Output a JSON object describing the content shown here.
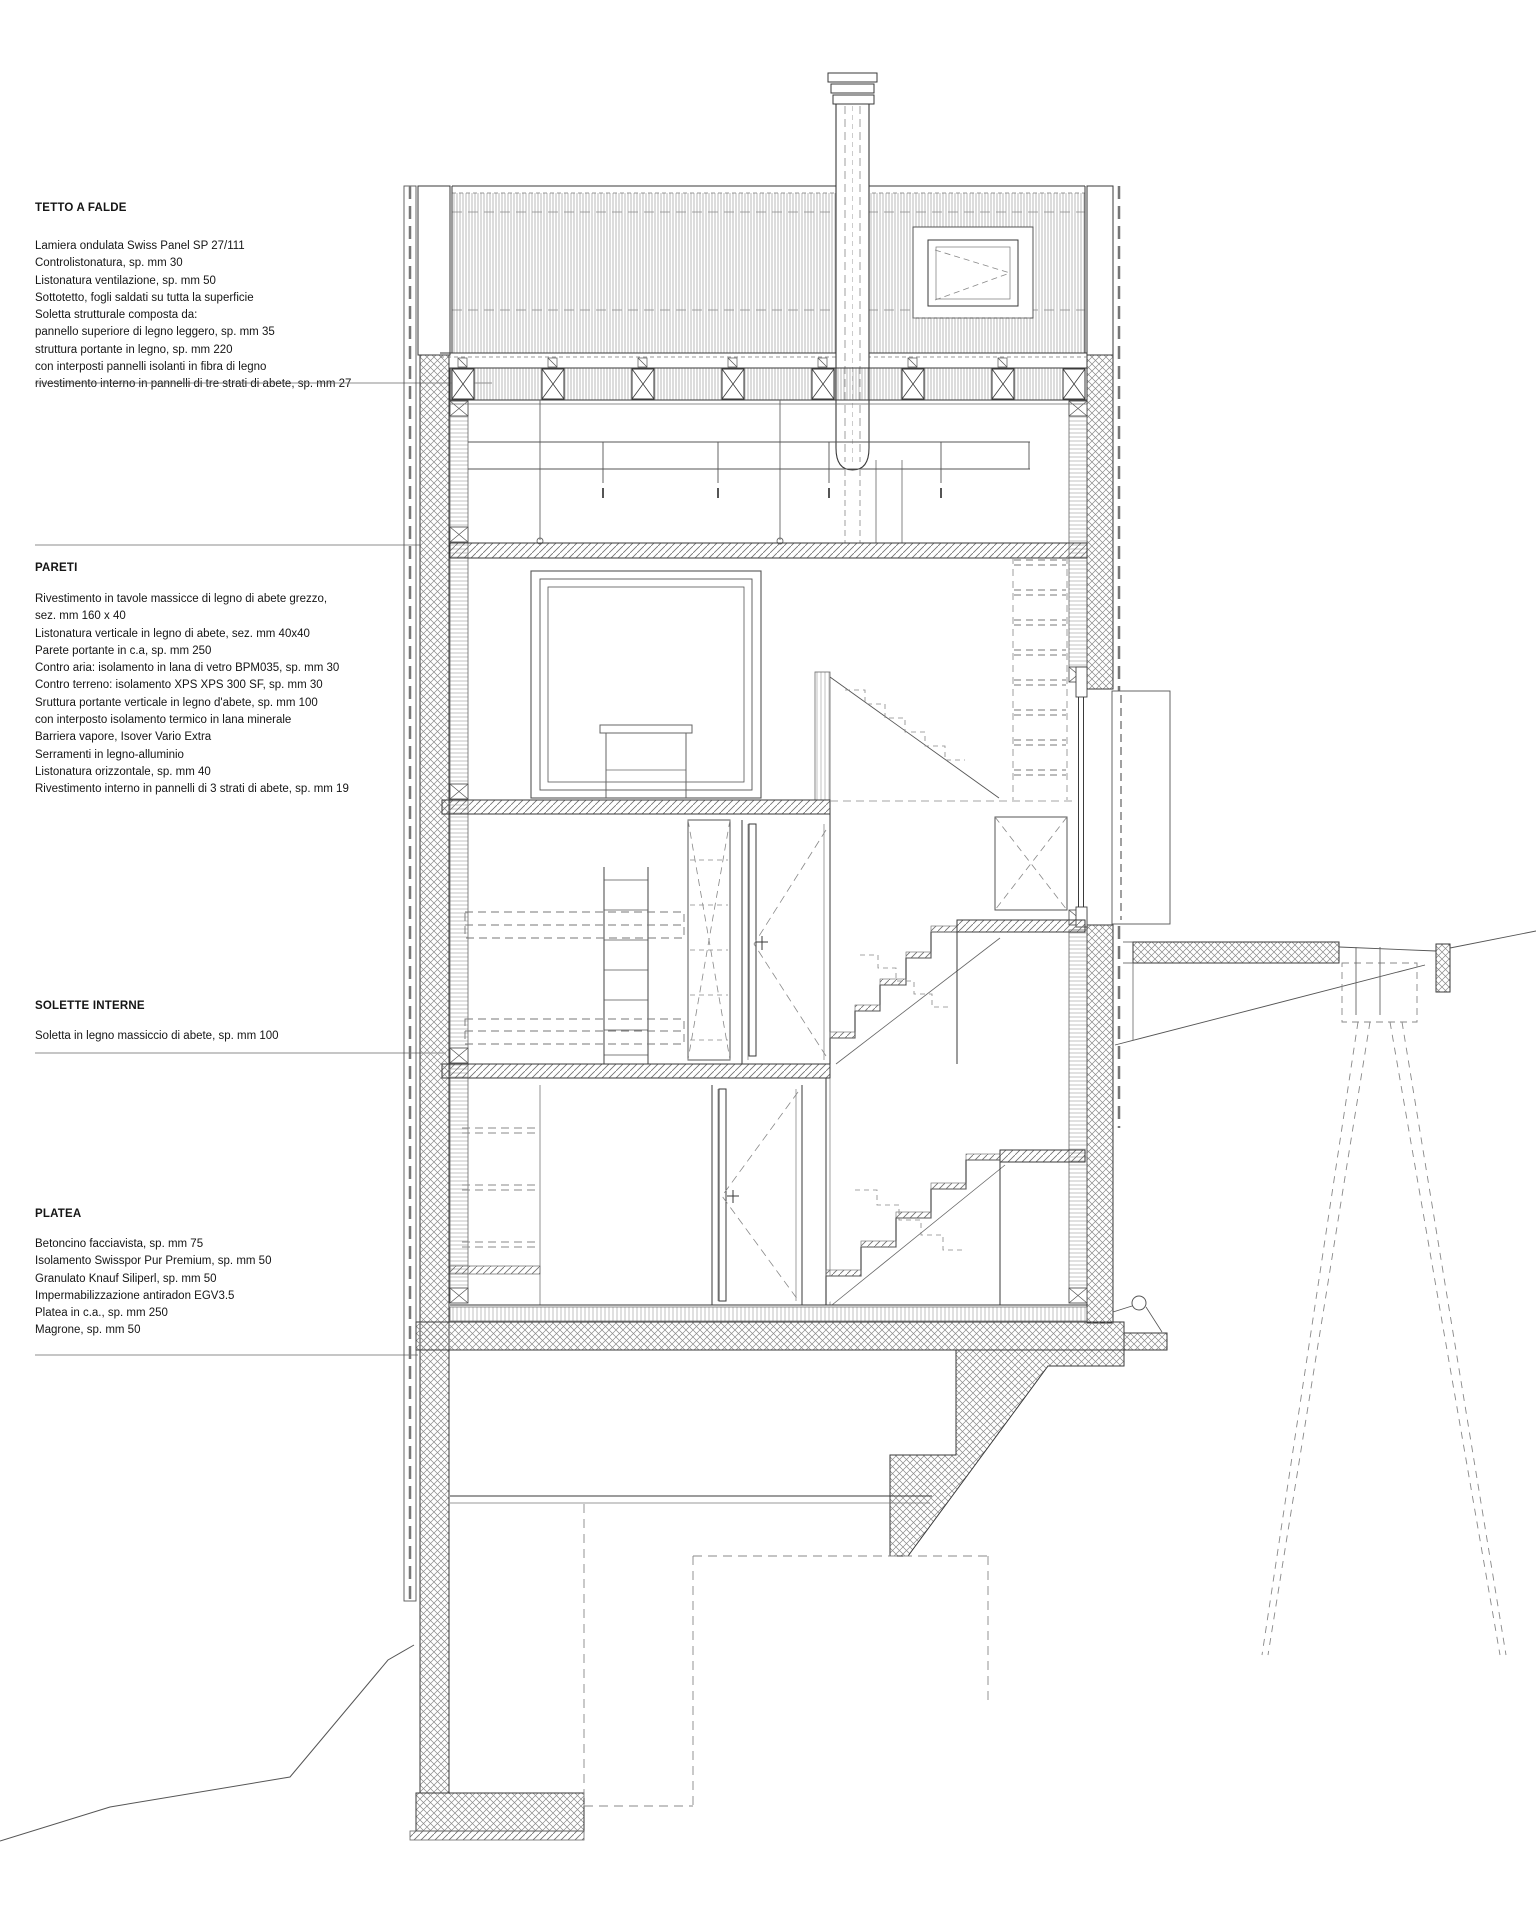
{
  "colors": {
    "ink": "#3a3a3a",
    "hatch": "#8a8a8a",
    "background": "#ffffff"
  },
  "annotations": {
    "tetto": {
      "heading": "TETTO A FALDE",
      "lines": [
        "Lamiera ondulata Swiss Panel SP 27/111",
        "Controlistonatura, sp. mm 30",
        "Listonatura ventilazione, sp. mm 50",
        "Sottotetto, fogli saldati su tutta la superficie",
        "Soletta strutturale composta da:",
        "pannello superiore di legno leggero, sp. mm 35",
        "struttura portante in legno, sp. mm 220",
        "con interposti pannelli isolanti in fibra di legno",
        "rivestimento interno in pannelli di tre strati di abete, sp. mm 27"
      ]
    },
    "pareti": {
      "heading": "PARETI",
      "lines": [
        "Rivestimento in tavole massicce di legno di abete grezzo,",
        "sez. mm 160 x 40",
        "Listonatura verticale in legno di abete, sez. mm 40x40",
        "Parete portante in c.a, sp. mm 250",
        "Contro aria: isolamento in lana di vetro BPM035, sp. mm 30",
        "Contro terreno: isolamento XPS XPS 300 SF, sp. mm 30",
        "Sruttura portante verticale in legno d'abete, sp. mm 100",
        "con interposto isolamento termico in lana minerale",
        "Barriera vapore, Isover Vario Extra",
        "Serramenti in legno-alluminio",
        "Listonatura orizzontale, sp. mm 40",
        "Rivestimento interno in pannelli di 3 strati di abete, sp. mm 19"
      ]
    },
    "solette": {
      "heading": "SOLETTE INTERNE",
      "lines": [
        "Soletta in legno massiccio di abete, sp. mm 100"
      ]
    },
    "platea": {
      "heading": "PLATEA",
      "lines": [
        "Betoncino facciavista, sp. mm 75",
        "Isolamento Swisspor Pur Premium, sp. mm 50",
        "Granulato Knauf Siliperl, sp. mm 50",
        "Impermabilizzazione antiradon EGV3.5",
        "Platea in c.a., sp. mm 250",
        "Magrone, sp. mm 50"
      ]
    }
  }
}
